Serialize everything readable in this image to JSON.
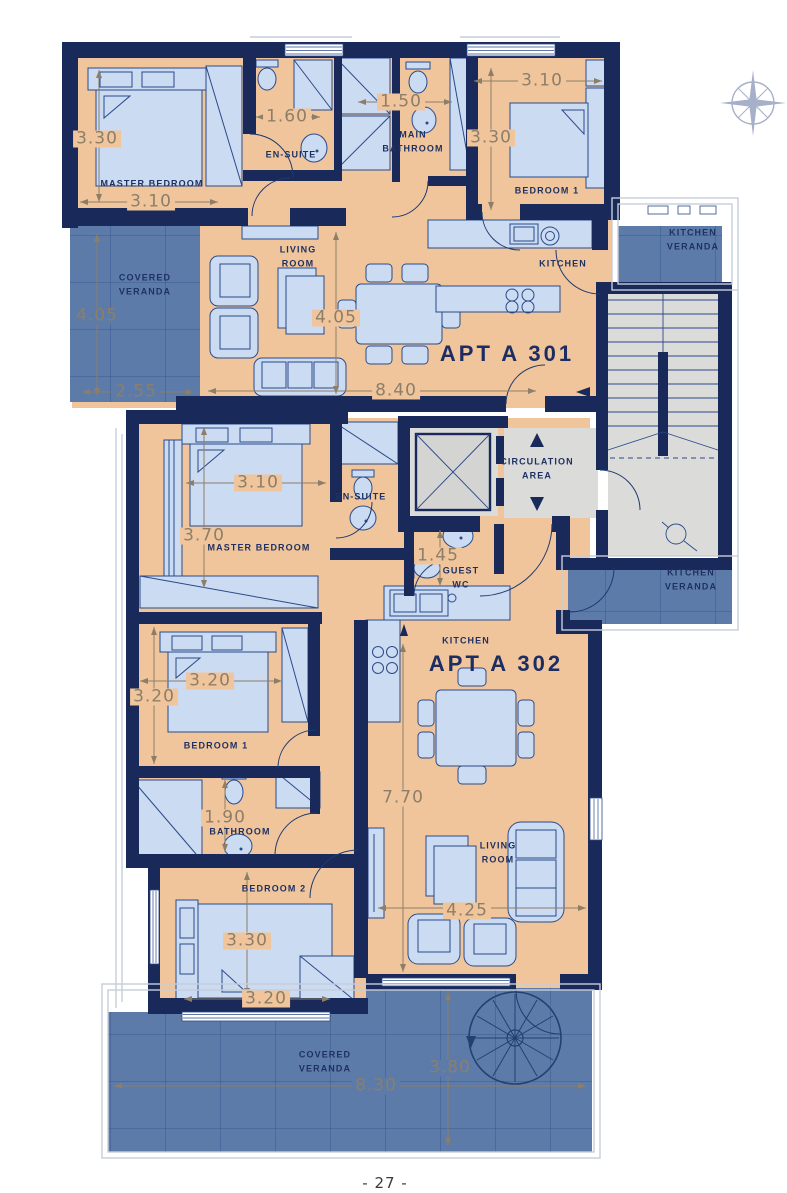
{
  "page": {
    "footer": "- 27 -"
  },
  "colors": {
    "wall": "#19295a",
    "floor": "#f0c59c",
    "furniture": "#cadbf2",
    "veranda": "#5d7ba9",
    "circulation": "#dbdbd9",
    "dimension_text": "#8d7e69",
    "label_text": "#1e3162"
  },
  "core": {
    "circulation": "CIRCULATION\nAREA"
  },
  "a301": {
    "name": "APT A 301",
    "rooms": {
      "master_bedroom": "MASTER BEDROOM",
      "en_suite": "EN-SUITE",
      "main_bathroom": "MAIN\nBATHROOM",
      "bedroom1": "BEDROOM 1",
      "living_room": "LIVING\nROOM",
      "kitchen": "KITCHEN",
      "covered_veranda": "COVERED\nVERANDA",
      "kitchen_veranda": "KITCHEN\nVERANDA"
    },
    "dims": {
      "master_h": "3.30",
      "master_w": "3.10",
      "ensuite_w": "1.60",
      "bathroom_w": "1.50",
      "bedroom1_w": "3.10",
      "bedroom1_h": "3.30",
      "veranda_h": "4.05",
      "veranda_w": "2.55",
      "living_h": "4.05",
      "living_w": "8.40"
    }
  },
  "a302": {
    "name": "APT A 302",
    "rooms": {
      "master_bedroom": "MASTER BEDROOM",
      "en_suite": "EN-SUITE",
      "guest_wc": "GUEST\nWC",
      "kitchen": "KITCHEN",
      "bedroom1": "BEDROOM 1",
      "bathroom": "BATHROOM",
      "bedroom2": "BEDROOM 2",
      "living_room": "LIVING\nROOM",
      "covered_veranda": "COVERED\nVERANDA",
      "kitchen_veranda": "KITCHEN\nVERANDA"
    },
    "dims": {
      "master_w": "3.10",
      "master_h": "3.70",
      "guest_wc_h": "1.45",
      "bedroom1_w": "3.20",
      "bedroom1_h": "3.20",
      "bathroom_h": "1.90",
      "bedroom2_h": "3.30",
      "bedroom2_w": "3.20",
      "living_h": "7.70",
      "living_w": "4.25",
      "veranda_w": "8.30",
      "veranda_h": "3.80"
    }
  }
}
